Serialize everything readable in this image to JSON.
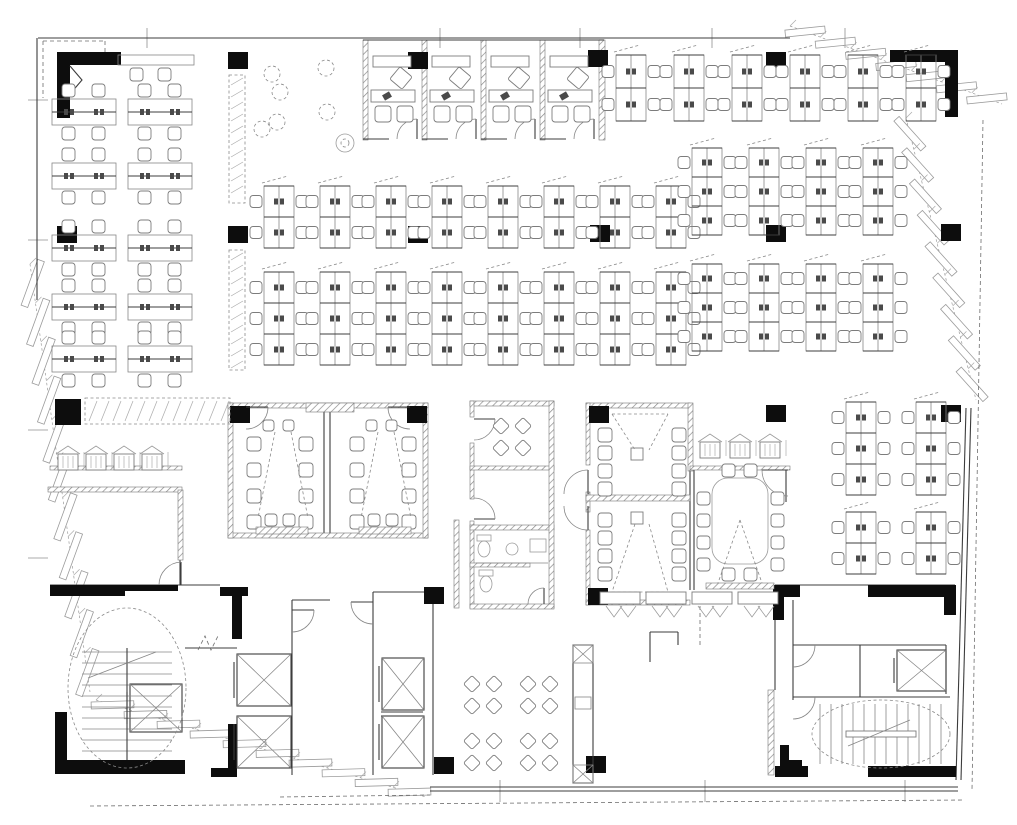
{
  "meta": {
    "drawing_type": "office-floor-plan",
    "canvas": {
      "w": 1017,
      "h": 825
    },
    "colors": {
      "ink": "#3c3c3c",
      "mid": "#6d6d6d",
      "light": "#8a8a8a",
      "black": "#0d0d0d",
      "bg": "#ffffff"
    }
  },
  "fp": {
    "columns": [
      [
        228,
        52
      ],
      [
        408,
        52
      ],
      [
        588,
        50
      ],
      [
        766,
        52
      ],
      [
        57,
        226
      ],
      [
        228,
        226
      ],
      [
        408,
        226
      ],
      [
        590,
        225
      ],
      [
        766,
        225
      ],
      [
        941,
        224
      ],
      [
        230,
        406
      ],
      [
        407,
        406
      ],
      [
        589,
        406
      ],
      [
        766,
        405
      ],
      [
        941,
        405
      ],
      [
        424,
        587
      ],
      [
        588,
        588
      ],
      [
        434,
        757
      ],
      [
        586,
        756
      ]
    ],
    "blackRects": [
      [
        57,
        52,
        64,
        13
      ],
      [
        57,
        52,
        13,
        66
      ],
      [
        890,
        50,
        68,
        12
      ],
      [
        945,
        55,
        13,
        62
      ],
      [
        55,
        399,
        26,
        26
      ],
      [
        50,
        585,
        75,
        11
      ],
      [
        123,
        585,
        55,
        6
      ],
      [
        55,
        760,
        130,
        14
      ],
      [
        55,
        712,
        12,
        62
      ],
      [
        220,
        587,
        28,
        9
      ],
      [
        232,
        587,
        10,
        52
      ],
      [
        228,
        724,
        9,
        46
      ],
      [
        211,
        768,
        26,
        9
      ],
      [
        773,
        585,
        27,
        12
      ],
      [
        773,
        585,
        11,
        35
      ],
      [
        868,
        585,
        88,
        12
      ],
      [
        944,
        585,
        12,
        30
      ],
      [
        868,
        766,
        88,
        11
      ],
      [
        775,
        766,
        33,
        11
      ],
      [
        780,
        745,
        9,
        24
      ],
      [
        780,
        760,
        22,
        9
      ]
    ],
    "walls": [
      [
        38,
        38,
        790,
        38
      ],
      [
        37,
        38,
        37,
        300
      ],
      [
        180,
        490,
        180,
        585
      ],
      [
        50,
        585,
        220,
        585
      ],
      [
        292,
        600,
        292,
        775
      ],
      [
        292,
        600,
        330,
        600
      ],
      [
        185,
        648,
        237,
        648
      ],
      [
        373,
        592,
        373,
        775
      ],
      [
        373,
        592,
        424,
        592
      ],
      [
        433,
        592,
        433,
        775
      ],
      [
        381,
        712,
        423,
        712
      ],
      [
        381,
        716,
        423,
        716
      ],
      [
        775,
        585,
        955,
        585
      ],
      [
        775,
        597,
        775,
        690
      ],
      [
        793,
        600,
        793,
        700
      ],
      [
        793,
        645,
        860,
        645
      ],
      [
        860,
        645,
        860,
        697
      ],
      [
        860,
        645,
        946,
        645
      ],
      [
        946,
        645,
        946,
        694
      ],
      [
        806,
        697,
        950,
        697
      ],
      [
        430,
        787,
        958,
        787
      ],
      [
        430,
        791,
        958,
        791
      ],
      [
        971,
        408,
        961,
        780
      ],
      [
        966,
        408,
        956,
        780
      ],
      [
        324,
        405,
        324,
        536
      ],
      [
        330,
        405,
        330,
        536
      ],
      [
        690,
        470,
        690,
        590
      ],
      [
        694,
        470,
        694,
        590
      ],
      [
        786,
        470,
        786,
        502
      ],
      [
        552,
        403,
        552,
        608
      ],
      [
        599,
        40,
        604,
        40
      ],
      [
        50,
        469,
        182,
        469
      ]
    ],
    "dlines": [
      [
        43,
        41,
        105,
        41
      ],
      [
        43,
        41,
        43,
        98
      ],
      [
        105,
        41,
        105,
        60
      ],
      [
        90,
        806,
        965,
        800
      ],
      [
        280,
        797,
        430,
        795
      ],
      [
        983,
        120,
        972,
        790
      ],
      [
        700,
        592,
        700,
        648
      ]
    ],
    "hatchWalls": [
      [
        363,
        40,
        5,
        100
      ],
      [
        422,
        40,
        5,
        100
      ],
      [
        481,
        40,
        5,
        100
      ],
      [
        540,
        40,
        5,
        100
      ],
      [
        599,
        40,
        6,
        100
      ],
      [
        48,
        487,
        134,
        5
      ],
      [
        178,
        490,
        5,
        70
      ],
      [
        228,
        403,
        200,
        5
      ],
      [
        228,
        533,
        200,
        5
      ],
      [
        228,
        403,
        5,
        135
      ],
      [
        423,
        403,
        5,
        135
      ],
      [
        306,
        403,
        48,
        9
      ],
      [
        470,
        401,
        84,
        5
      ],
      [
        470,
        401,
        4,
        16
      ],
      [
        470,
        443,
        4,
        56
      ],
      [
        470,
        521,
        4,
        87
      ],
      [
        470,
        466,
        84,
        4
      ],
      [
        470,
        525,
        84,
        5
      ],
      [
        549,
        401,
        5,
        207
      ],
      [
        470,
        563,
        60,
        4
      ],
      [
        470,
        604,
        84,
        5
      ],
      [
        586,
        403,
        104,
        5
      ],
      [
        586,
        403,
        4,
        62
      ],
      [
        586,
        492,
        4,
        20
      ],
      [
        586,
        530,
        4,
        75
      ],
      [
        688,
        403,
        5,
        68
      ],
      [
        586,
        495,
        104,
        6
      ],
      [
        586,
        600,
        104,
        5
      ],
      [
        690,
        466,
        100,
        4
      ],
      [
        50,
        466,
        132,
        4
      ],
      [
        454,
        520,
        5,
        88
      ],
      [
        768,
        690,
        6,
        85
      ]
    ],
    "doors": [
      {
        "h": [
          417,
          139
        ],
        "l": [
          417,
          119
        ],
        "e": [
          397,
          139
        ]
      },
      {
        "h": [
          476,
          139
        ],
        "l": [
          476,
          119
        ],
        "e": [
          456,
          139
        ]
      },
      {
        "h": [
          535,
          139
        ],
        "l": [
          535,
          119
        ],
        "e": [
          515,
          139
        ]
      },
      {
        "h": [
          594,
          139
        ],
        "l": [
          594,
          119
        ],
        "e": [
          574,
          139
        ]
      },
      {
        "h": [
          246,
          407
        ],
        "l": [
          268,
          407
        ],
        "e": [
          246,
          429
        ]
      },
      {
        "h": [
          410,
          407
        ],
        "l": [
          388,
          407
        ],
        "e": [
          410,
          429
        ]
      },
      {
        "h": [
          474,
          419
        ],
        "l": [
          495,
          419
        ],
        "e": [
          474,
          440
        ]
      },
      {
        "h": [
          474,
          519
        ],
        "l": [
          495,
          519
        ],
        "e": [
          474,
          498
        ]
      },
      {
        "h": [
          544,
          604
        ],
        "l": [
          544,
          588
        ],
        "e": [
          528,
          604
        ]
      },
      {
        "h": [
          588,
          494
        ],
        "l": [
          588,
          470
        ],
        "e": [
          564,
          494
        ]
      },
      {
        "h": [
          588,
          506
        ],
        "l": [
          588,
          530
        ],
        "e": [
          564,
          506
        ]
      },
      {
        "h": [
          788,
          470
        ],
        "l": [
          762,
          470
        ],
        "e": [
          788,
          496
        ]
      },
      {
        "h": [
          373,
          602
        ],
        "l": [
          351,
          602
        ],
        "e": [
          373,
          624
        ]
      },
      {
        "h": [
          292,
          610
        ],
        "l": [
          314,
          610
        ],
        "e": [
          292,
          632
        ]
      },
      {
        "h": [
          793,
          645
        ],
        "l": [
          815,
          645
        ],
        "e": [
          793,
          667
        ]
      },
      {
        "h": [
          793,
          697
        ],
        "l": [
          815,
          697
        ],
        "e": [
          793,
          719
        ]
      },
      {
        "h": [
          181,
          585
        ],
        "l": [
          181,
          562
        ],
        "e": [
          159,
          585
        ]
      }
    ],
    "deskStripGroups": [
      {
        "x0": 264,
        "pitch": 56,
        "n": 8,
        "y": 186,
        "units": 2,
        "uh": 31,
        "w": 30
      },
      {
        "x0": 264,
        "pitch": 56,
        "n": 8,
        "y": 272,
        "units": 3,
        "uh": 31,
        "w": 30
      },
      {
        "x0": 692,
        "pitch": 57,
        "n": 4,
        "y": 148,
        "units": 3,
        "uh": 29,
        "w": 30
      },
      {
        "x0": 692,
        "pitch": 57,
        "n": 4,
        "y": 264,
        "units": 3,
        "uh": 29,
        "w": 30
      },
      {
        "x0": 616,
        "pitch": 58,
        "n": 6,
        "y": 55,
        "units": 2,
        "uh": 33,
        "w": 30
      },
      {
        "x0": 846,
        "pitch": 70,
        "n": 2,
        "y": 402,
        "units": 3,
        "uh": 31,
        "w": 30
      },
      {
        "x0": 846,
        "pitch": 70,
        "n": 2,
        "y": 512,
        "units": 2,
        "uh": 31,
        "w": 30
      }
    ],
    "benchGroup": {
      "cols": [
        52,
        128
      ],
      "cellW": 64,
      "rows": [
        112,
        176,
        248,
        307,
        359
      ]
    },
    "topBench": {
      "x": 118,
      "y": 55,
      "w": 76,
      "h": 10,
      "chairs": [
        [
          130,
          68
        ],
        [
          158,
          68
        ]
      ]
    },
    "officeRow": {
      "walls": [
        363,
        422,
        481,
        540,
        599
      ],
      "top": 40,
      "bottom": 139,
      "doorGap": 26
    },
    "trainingRooms": [
      {
        "ox": 240,
        "chL": 247,
        "chR": 299,
        "chY": [
          437,
          463,
          489,
          515
        ],
        "topPair": [
          [
            263,
            420
          ],
          [
            283,
            420
          ]
        ],
        "botPair": [
          [
            265,
            514
          ],
          [
            283,
            514
          ]
        ],
        "cone": "M275,432 L258,518 M291,432 L308,518",
        "screen": [
          256,
          527,
          52,
          7
        ]
      },
      {
        "ox": 343,
        "chL": 350,
        "chR": 402,
        "chY": [
          437,
          463,
          489,
          515
        ],
        "topPair": [
          [
            366,
            420
          ],
          [
            386,
            420
          ]
        ],
        "botPair": [
          [
            368,
            514
          ],
          [
            386,
            514
          ]
        ],
        "cone": "M378,432 L361,518 M394,432 L411,518",
        "screen": [
          359,
          527,
          52,
          7
        ]
      }
    ],
    "confRooms": [
      {
        "chL": 598,
        "chR": 672,
        "chY": [
          428,
          446,
          464,
          482
        ],
        "sq": [
          631,
          448,
          12
        ],
        "cone": "M612,414 L635,450 M668,414 L649,450 M612,414 L668,414"
      },
      {
        "chL": 598,
        "chR": 672,
        "chY": [
          513,
          531,
          549,
          567
        ],
        "sq": [
          631,
          512,
          12
        ],
        "cone": "M635,524 L612,592 M649,524 L668,592 M612,592 L668,592"
      }
    ],
    "ovalRoom": {
      "table": [
        712,
        478,
        56,
        86,
        16
      ],
      "chL": 697,
      "chR": 771,
      "chY": [
        492,
        514,
        536,
        558
      ],
      "topPair": [
        [
          722,
          464
        ],
        [
          744,
          464
        ]
      ],
      "botPair": [
        [
          722,
          568
        ],
        [
          744,
          568
        ]
      ],
      "cone": "M740,520 L718,583 M740,520 L762,583",
      "screen": [
        706,
        583,
        68,
        6
      ]
    },
    "foldTables": {
      "xs": [
        600,
        646,
        692,
        738
      ],
      "y": 592,
      "w": 40,
      "h": 12
    },
    "breakClusters": [
      [
        483,
        695
      ],
      [
        539,
        695
      ],
      [
        483,
        752
      ],
      [
        539,
        752
      ],
      [
        512,
        437
      ]
    ],
    "loungeCircles": [
      [
        272,
        74
      ],
      [
        280,
        92
      ],
      [
        326,
        68
      ],
      [
        327,
        112
      ],
      [
        262,
        129
      ],
      [
        277,
        122
      ]
    ],
    "flower": [
      345,
      143,
      9
    ],
    "houseMarks": {
      "left": {
        "xs": [
          58,
          86,
          114,
          142
        ],
        "y": 446
      },
      "right": {
        "xs": [
          700,
          730,
          760
        ],
        "y": 434
      }
    },
    "lockerStrips": [
      [
        85,
        398,
        145,
        26
      ],
      [
        229,
        75,
        16,
        128
      ],
      [
        229,
        250,
        16,
        120
      ]
    ],
    "elevators": [
      [
        130,
        684,
        52,
        48
      ],
      [
        237,
        654,
        54,
        52
      ],
      [
        237,
        716,
        54,
        52
      ],
      [
        382,
        658,
        42,
        52
      ],
      [
        382,
        716,
        42,
        52
      ],
      [
        897,
        650,
        49,
        41
      ]
    ],
    "stairs": [
      {
        "x": 68,
        "y": 608,
        "w": 118,
        "h": 160,
        "dir": "h"
      },
      {
        "x": 812,
        "y": 700,
        "w": 138,
        "h": 68,
        "dir": "v"
      }
    ],
    "shaftStrip": [
      573,
      645,
      20,
      138
    ],
    "counter": [
      [
        650,
        662,
        650,
        632
      ],
      [
        650,
        632,
        678,
        632
      ],
      [
        678,
        632,
        678,
        645
      ]
    ],
    "mdoor": "M198,650 L205,636 L211,650 L218,636",
    "cornerDoor": "M70,66 L82,80 L70,94",
    "restroom": {
      "toilets": [
        [
          484,
          549
        ],
        [
          486,
          584
        ]
      ],
      "sink": [
        512,
        549,
        6
      ],
      "counterBox": [
        530,
        539,
        16,
        13
      ],
      "lines": [
        [
          476,
          563,
          548,
          563
        ]
      ]
    },
    "facadeRuns": [
      {
        "x1": 790,
        "y1": 26,
        "x2": 1002,
        "y2": 104,
        "n": 7,
        "tilt": -26
      },
      {
        "x1": 906,
        "y1": 118,
        "x2": 976,
        "y2": 400,
        "n": 9,
        "tilt": -28
      },
      {
        "x1": 30,
        "y1": 264,
        "x2": 90,
        "y2": 692,
        "n": 11,
        "tilt": 28
      },
      {
        "x1": 96,
        "y1": 700,
        "x2": 426,
        "y2": 797,
        "n": 10,
        "tilt": -18
      }
    ],
    "gridTicks": {
      "top": {
        "xs": [
          147,
          440,
          580,
          712,
          845
        ],
        "y1": 28,
        "y2": 48
      },
      "left": {
        "ys": [
          100,
          240,
          430,
          558
        ],
        "x1": 28,
        "x2": 48
      },
      "bottom": {
        "xs": [
          500,
          705,
          905
        ],
        "y1": 780,
        "y2": 802
      }
    }
  }
}
